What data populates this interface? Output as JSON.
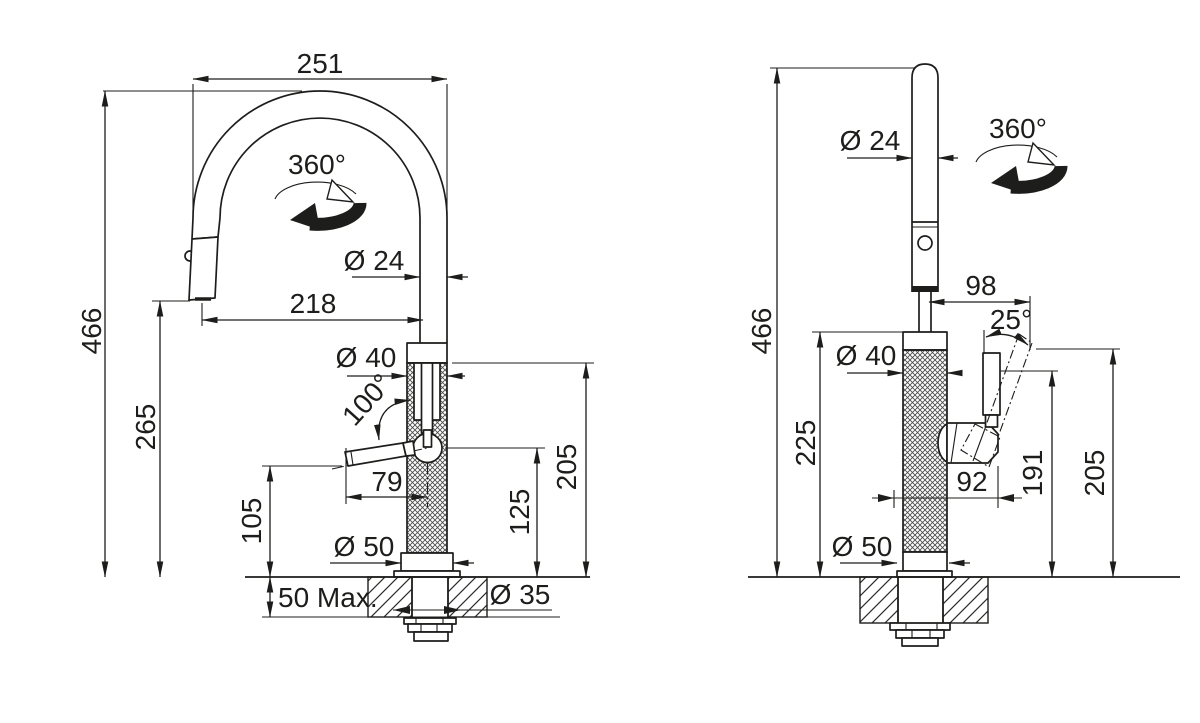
{
  "colors": {
    "line": "#1d1d1b",
    "background": "#ffffff"
  },
  "front_view": {
    "labels": {
      "overall_width": "251",
      "swivel_range": "360°",
      "spout_tube_diameter": "Ø 24",
      "spout_reach": "218",
      "overall_height": "466",
      "outlet_height": "265",
      "body_diameter": "Ø 40",
      "handle_swing_angle": "100°",
      "handle_length": "79",
      "handle_clearance_height": "105",
      "valve_center_height": "125",
      "body_top_height": "205",
      "base_diameter": "Ø 50",
      "deck_thickness_max": "50 Max.",
      "mounting_hole_diameter": "Ø 35"
    }
  },
  "side_view": {
    "labels": {
      "spray_tube_diameter": "Ø 24",
      "swivel_range": "360°",
      "handle_reach": "98",
      "overall_height": "466",
      "handle_tilt_angle": "25°",
      "body_diameter": "Ø 40",
      "body_height": "225",
      "handle_offset": "92",
      "handle_pivot_height": "191",
      "handle_top_height": "205",
      "base_diameter": "Ø 50"
    }
  }
}
